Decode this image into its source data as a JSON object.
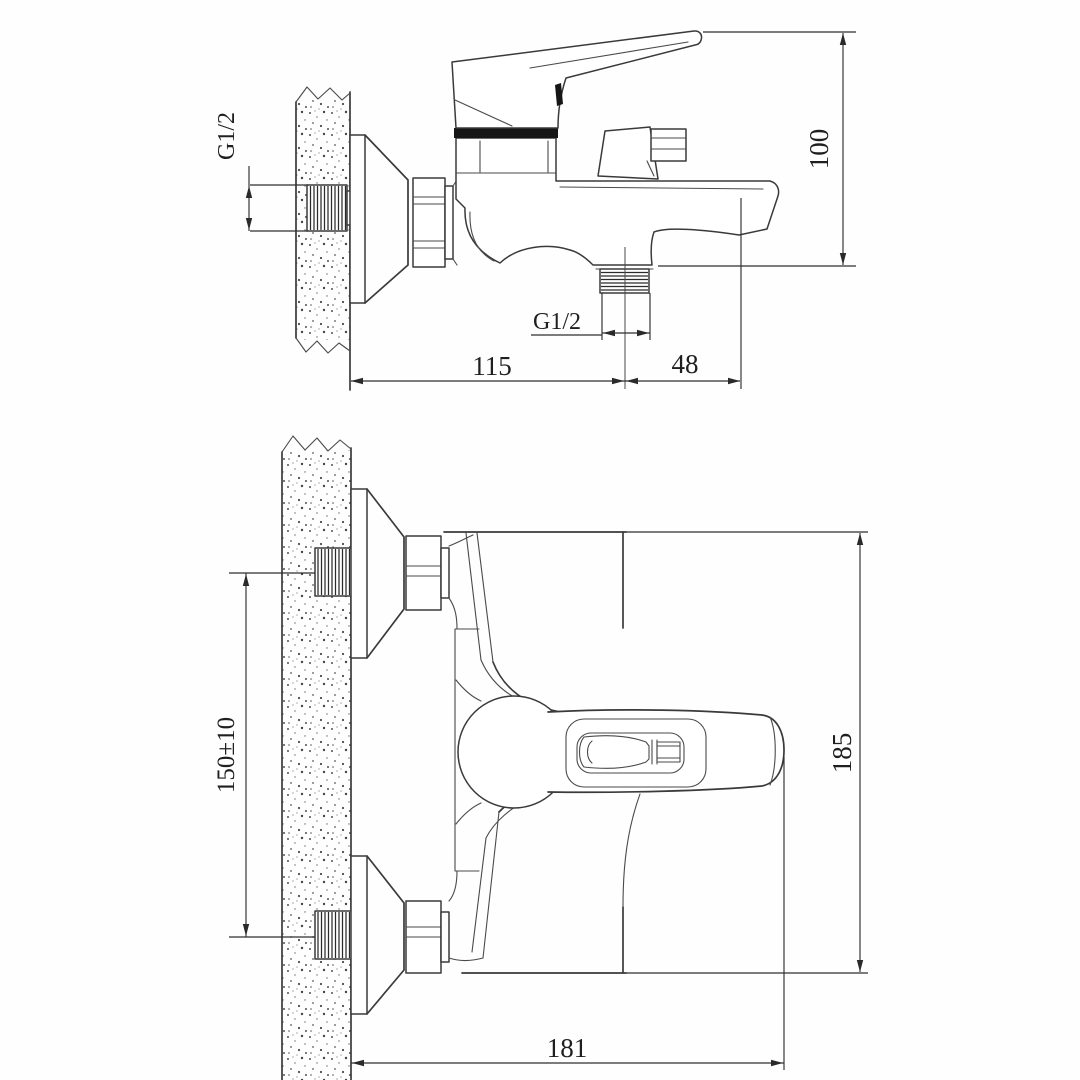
{
  "colors": {
    "background": "#fefefe",
    "line": "#3a3a3a",
    "dimension_line": "#2f2f2f",
    "text": "#1f1f1f",
    "dark_fill": "#161616"
  },
  "side_view": {
    "dim_wall_thread_label": "G1/2",
    "dim_height_label": "100",
    "dim_wall_to_outlet_label": "115",
    "dim_outlet_to_spout_label": "48",
    "dim_outlet_thread_label": "G1/2"
  },
  "plan_view": {
    "dim_inlet_spacing_label": "150±10",
    "dim_depth_label": "185",
    "dim_wall_to_handle_label": "181"
  }
}
